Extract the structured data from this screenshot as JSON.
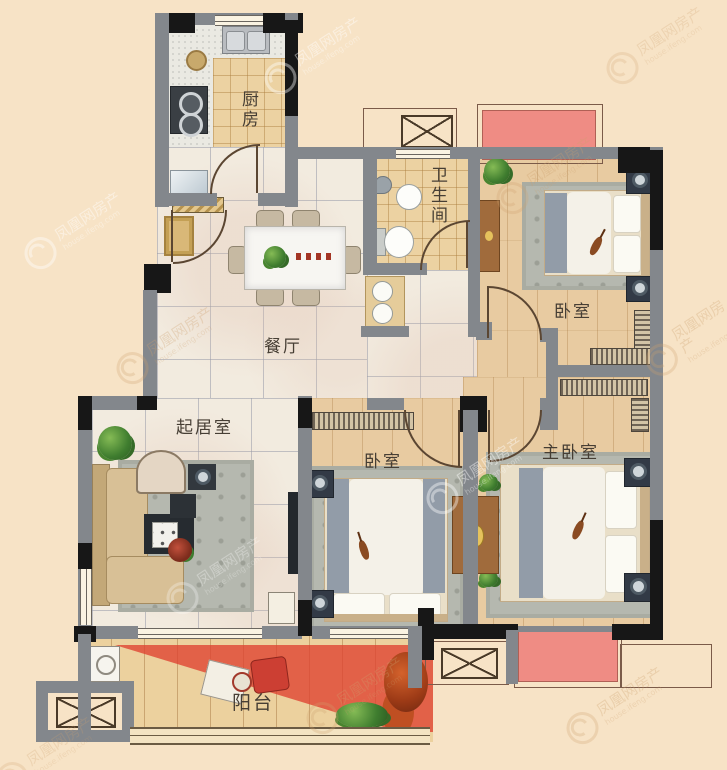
{
  "watermark": {
    "brand": "凤凰网房产",
    "domain": "house.ifeng.com"
  },
  "rooms": {
    "kitchen": {
      "label": "厨房"
    },
    "dining": {
      "label": "餐厅"
    },
    "bathroom": {
      "label": "卫生间"
    },
    "bedroom_north": {
      "label": "卧室"
    },
    "living": {
      "label": "起居室"
    },
    "bedroom_middle": {
      "label": "卧室"
    },
    "master_bedroom": {
      "label": "主卧室"
    },
    "balcony": {
      "label": "阳台"
    }
  },
  "colors": {
    "background": "#f7e3c6",
    "wall": "#83878c",
    "wall_dark": "#171717",
    "floor_marble": "#f2ebdf",
    "floor_wood": "#e8cba1",
    "floor_tile": "#ecd2a2",
    "balcony_red": "#df4130",
    "flower_bed": "#ef8c84",
    "rug": "#b5b8af",
    "sofa": "#d8c096",
    "wardrobe_wood": "#a06b3c",
    "label_text": "#463e34"
  }
}
